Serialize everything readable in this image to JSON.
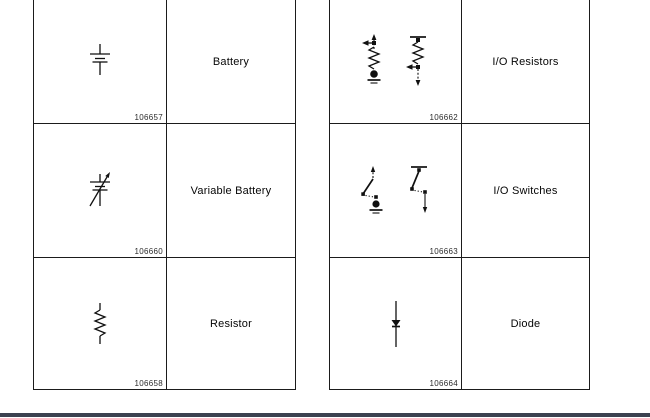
{
  "page": {
    "background": "#ffffff",
    "bottom_rule_color": "#3c4250",
    "border_color": "#1b1b1b"
  },
  "tables": [
    {
      "name": "left-symbol-table",
      "rows": [
        {
          "icon": "battery-icon",
          "id": "106657",
          "label": "Battery"
        },
        {
          "icon": "variable-battery-icon",
          "id": "106660",
          "label": "Variable Battery"
        },
        {
          "icon": "resistor-icon",
          "id": "106658",
          "label": "Resistor"
        }
      ]
    },
    {
      "name": "right-symbol-table",
      "rows": [
        {
          "icon": "io-resistors-icon",
          "id": "106662",
          "label": "I/O Resistors"
        },
        {
          "icon": "io-switches-icon",
          "id": "106663",
          "label": "I/O Switches"
        },
        {
          "icon": "diode-icon",
          "id": "106664",
          "label": "Diode"
        }
      ]
    }
  ]
}
